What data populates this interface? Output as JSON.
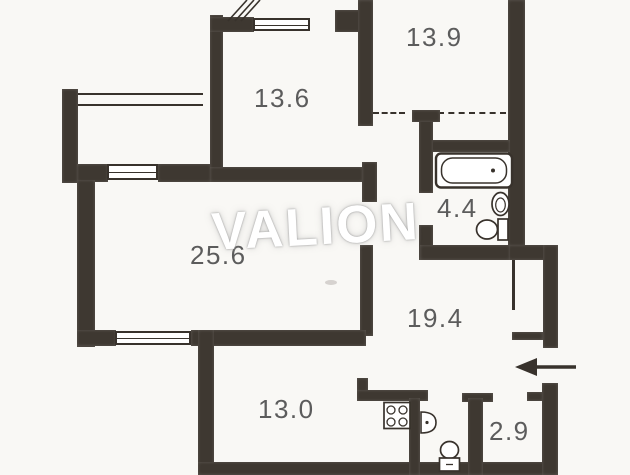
{
  "watermark": "VALION",
  "room_areas": [
    {
      "id": "room-top-right",
      "label": "13.9"
    },
    {
      "id": "room-top-center",
      "label": "13.6"
    },
    {
      "id": "room-living",
      "label": "25.6"
    },
    {
      "id": "room-bathroom",
      "label": "4.4"
    },
    {
      "id": "room-hallway",
      "label": "19.4"
    },
    {
      "id": "room-kitchen",
      "label": "13.0"
    },
    {
      "id": "room-closet",
      "label": "2.9"
    }
  ],
  "fixtures": {
    "bathroom": [
      "bathtub-icon",
      "pedestal-sink-icon",
      "toilet-icon"
    ],
    "wc": [
      "washbasin-icon",
      "toilet-icon"
    ],
    "kitchen": [
      "stove-icon"
    ],
    "entrance": [
      "entrance-arrow-icon"
    ]
  },
  "entrance": {
    "arrow_direction": "left"
  },
  "colors": {
    "wall": "#3e3831",
    "line": "#38322c",
    "label_text": "#5c5c5c",
    "background": "#f9f8f5",
    "watermark": "#ffffff"
  }
}
